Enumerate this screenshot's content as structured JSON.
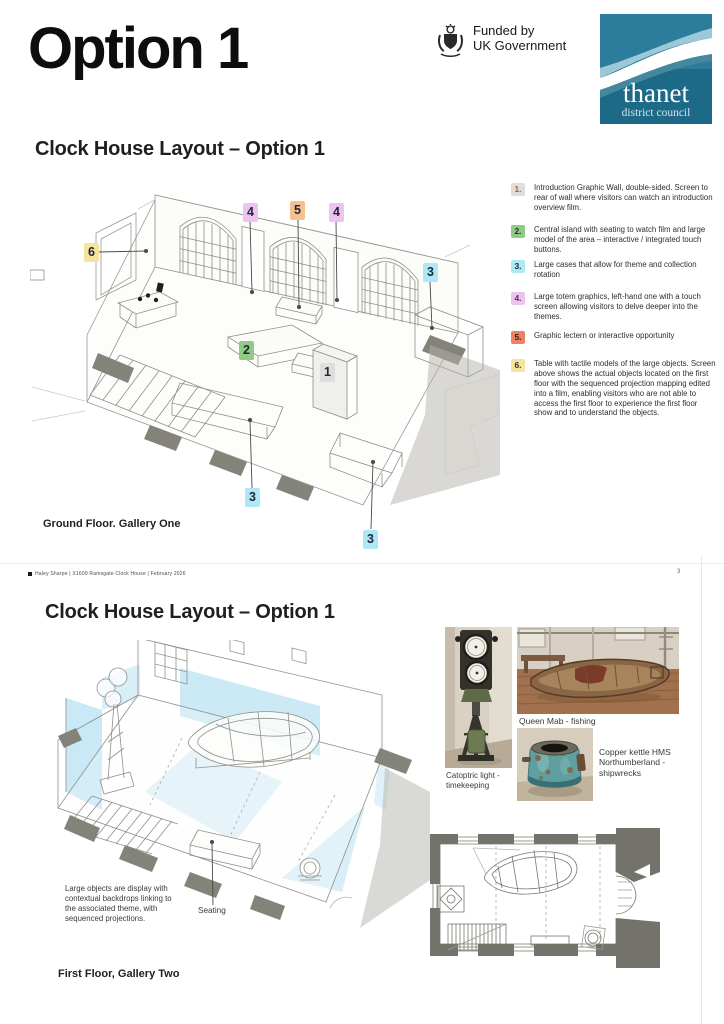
{
  "page": {
    "title": "Option 1",
    "page_number": "3",
    "footer": "Haley Sharpe  |   X1609 Ramsgate Clock House |  February 2026"
  },
  "header": {
    "funded_by": "Funded by",
    "uk_government": "UK Government",
    "thanet": "thanet",
    "district_council": "district council",
    "thanet_teal_top": "#2c7d9c",
    "thanet_teal_bottom": "#1c6a88"
  },
  "section1": {
    "title": "Clock House Layout – Option 1",
    "caption": "Ground Floor. Gallery One",
    "legend": [
      {
        "num": "1.",
        "chip": "#dededd",
        "num_color": "#bf5b21",
        "text": "Introduction Graphic Wall, double-sided. Screen to rear of wall where visitors can watch an introduction overview film."
      },
      {
        "num": "2.",
        "chip": "#8ecc86",
        "num_color": "#22302a",
        "text": "Central island with seating to watch film and large model of the area – interactive / integrated touch buttons."
      },
      {
        "num": "3.",
        "chip": "#aee8f6",
        "num_color": "#1f2c33",
        "text": "Large cases that allow for theme and collection rotation"
      },
      {
        "num": "4.",
        "chip": "#efc3ef",
        "num_color": "#5f2a6e",
        "text": "Large totem graphics, left-hand one with a touch screen allowing visitors to delve deeper into the themes."
      },
      {
        "num": "5.",
        "chip": "#ec8262",
        "num_color": "#34221c",
        "text": "Graphic lectern or interactive opportunity"
      },
      {
        "num": "6.",
        "chip": "#f6e39e",
        "num_color": "#3a3420",
        "text": "Table with tactile models of the large objects. Screen above shows the actual objects located on the first floor with the sequenced projection mapping edited into a film, enabling visitors who are not able to access the first floor to experience the first floor show and to understand the objects."
      }
    ],
    "markers": [
      {
        "text": "4",
        "bg": "#efc3ef"
      },
      {
        "text": "5",
        "bg": "#f6c190"
      },
      {
        "text": "4",
        "bg": "#efc3ef"
      },
      {
        "text": "6",
        "bg": "#f6e39e"
      },
      {
        "text": "3",
        "bg": "#aee8f6"
      },
      {
        "text": "2",
        "bg": "#8ecc86"
      },
      {
        "text": "1",
        "bg": "#dededd"
      },
      {
        "text": "3",
        "bg": "#aee8f6"
      },
      {
        "text": "3",
        "bg": "#aee8f6"
      }
    ]
  },
  "section2": {
    "title": "Clock House Layout – Option 1",
    "caption": "First Floor, Gallery Two",
    "annotation": "Large objects are display with contextual backdrops linking to the associated theme, with sequenced  projections.",
    "seating_label": "Seating",
    "projection_blue": "#bfe5f4",
    "photos": [
      {
        "caption": "Catoptric light - timekeeping"
      },
      {
        "caption": "Queen Mab - fishing"
      },
      {
        "caption": "Copper kettle HMS Northumberland - shipwrecks"
      }
    ]
  }
}
